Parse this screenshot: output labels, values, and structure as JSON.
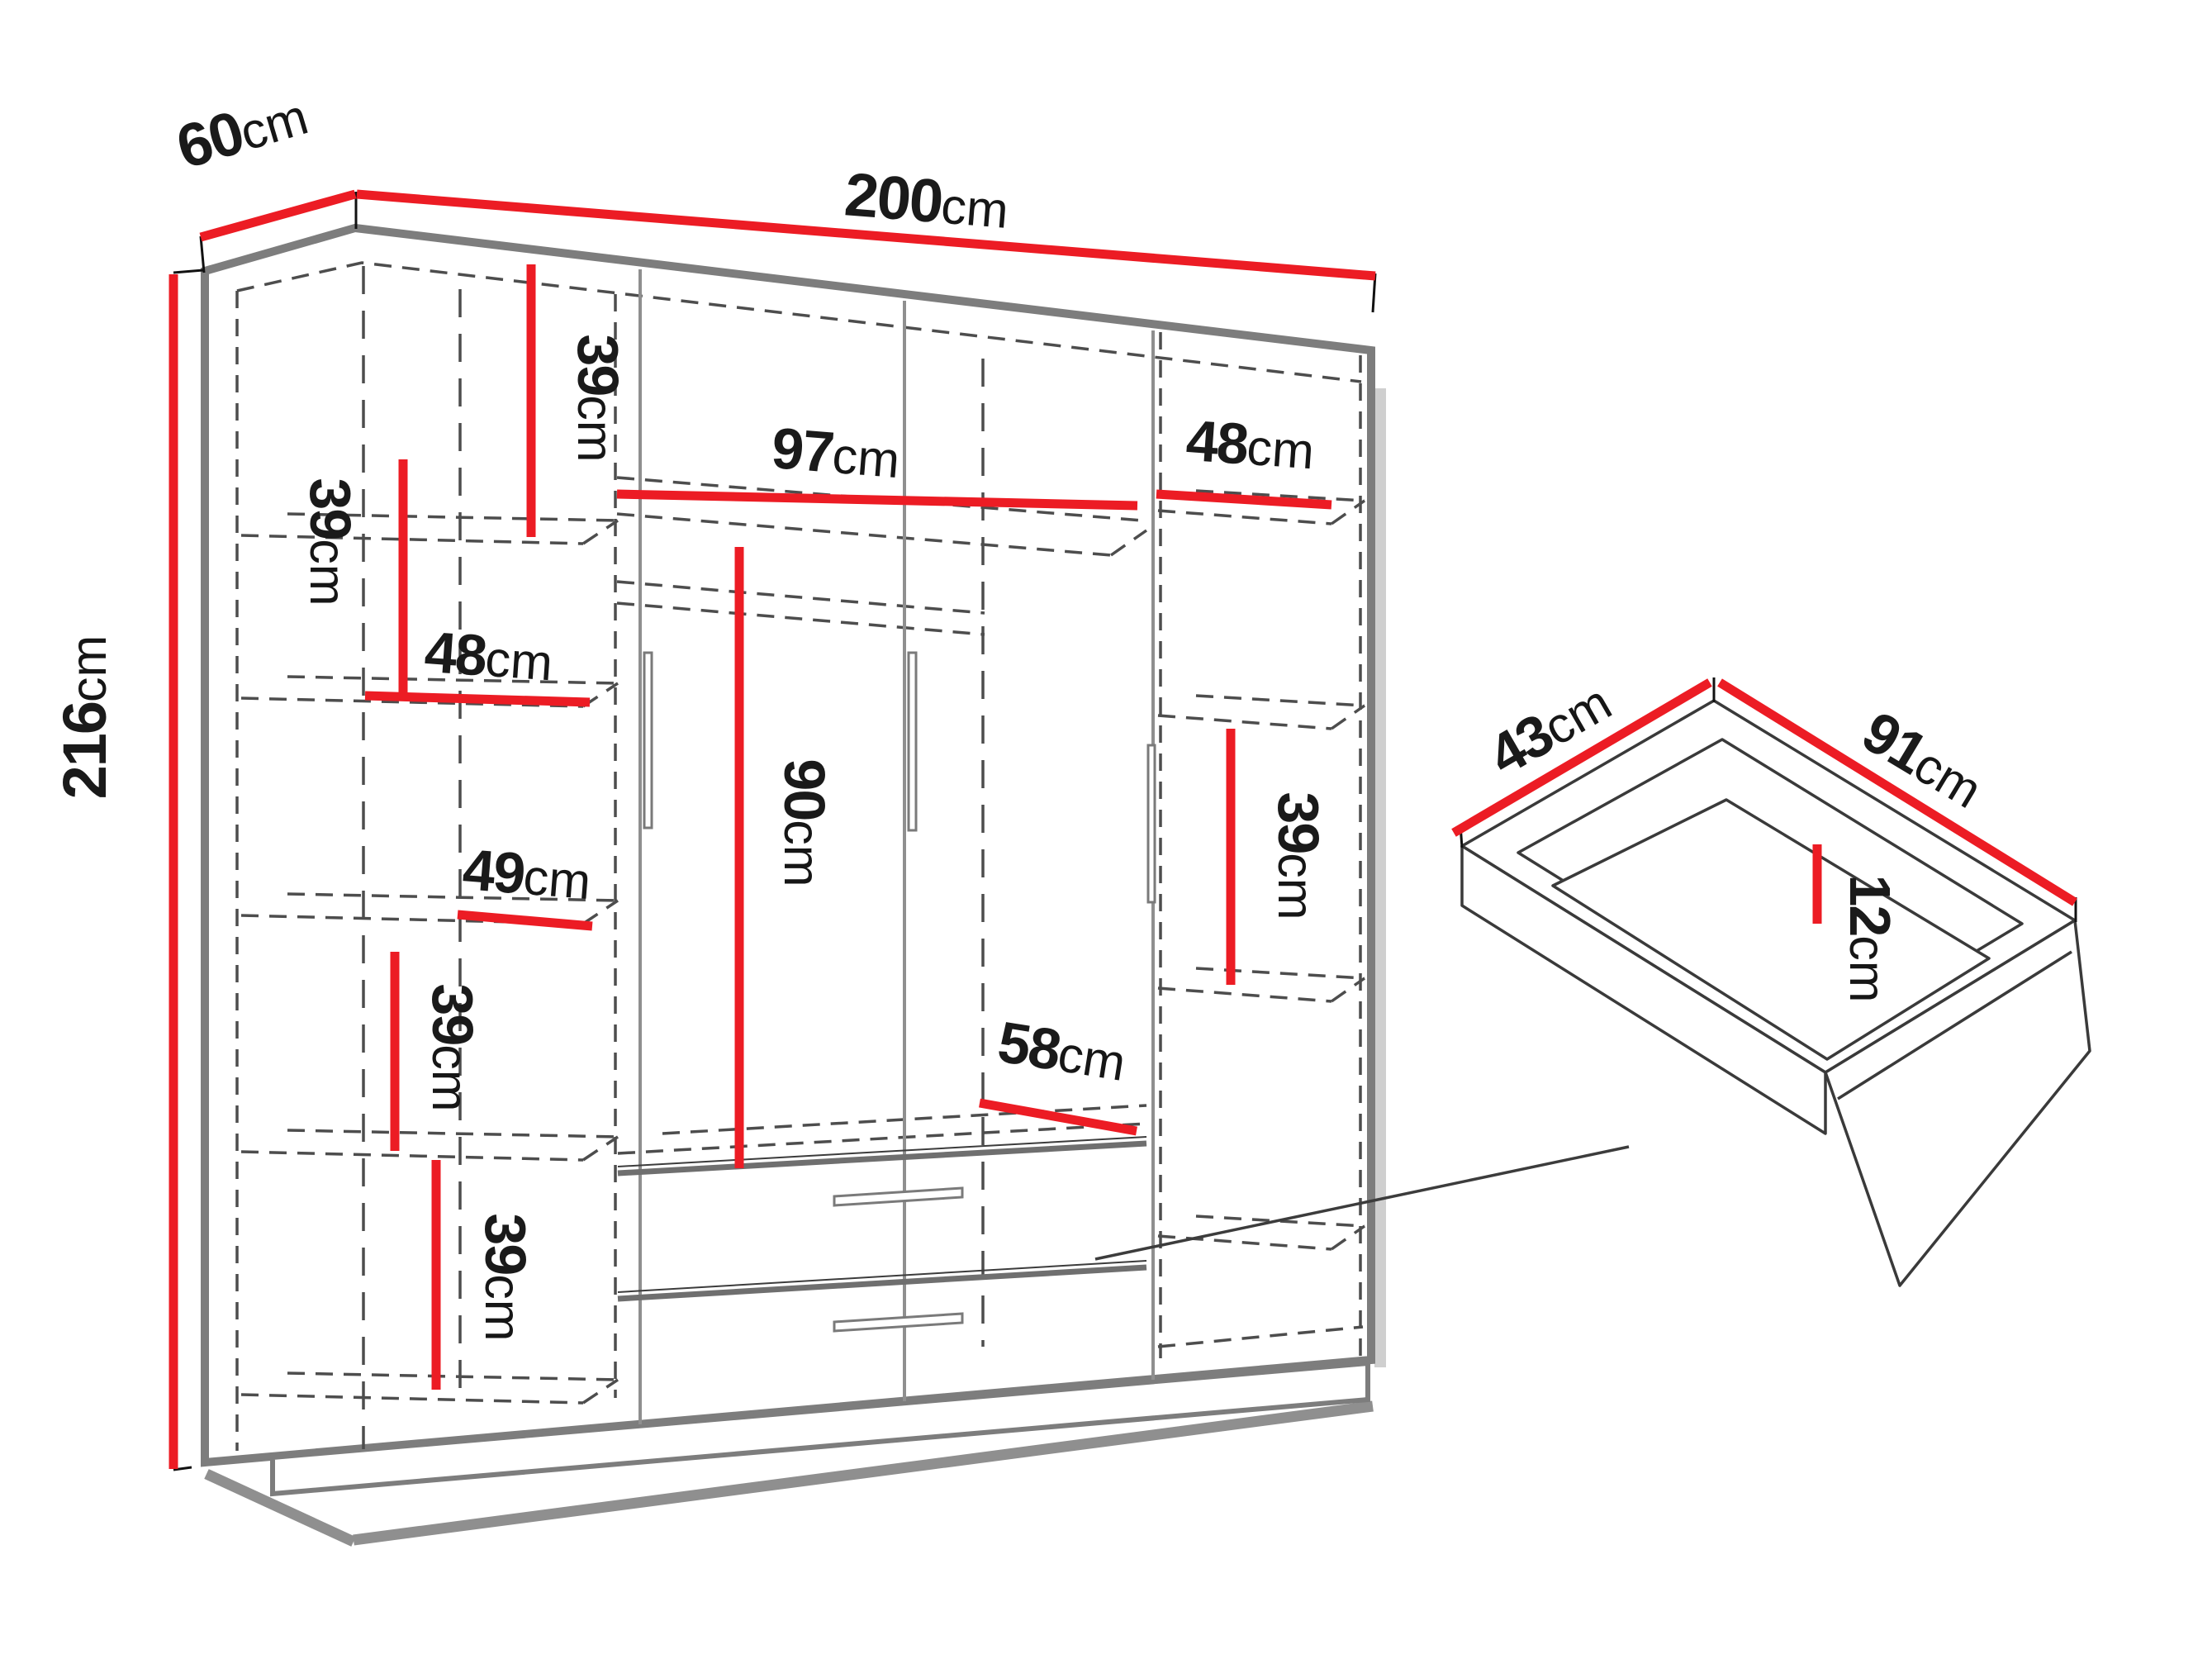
{
  "colors": {
    "dimension_red": "#ec1c24",
    "outline_gray": "#7d7d7d",
    "dash_gray": "#4d4d4d",
    "text_black": "#1a1a1a"
  },
  "wardrobe": {
    "width": {
      "value": "200",
      "unit": "cm"
    },
    "depth": {
      "value": "60",
      "unit": "cm"
    },
    "height": {
      "value": "216",
      "unit": "cm"
    },
    "interior": {
      "left_top_compartment": {
        "value": "39",
        "unit": "cm"
      },
      "left_upper_compartment": {
        "value": "39",
        "unit": "cm"
      },
      "left_shelf_width_upper": {
        "value": "48",
        "unit": "cm"
      },
      "left_shelf_width_lower": {
        "value": "49",
        "unit": "cm"
      },
      "left_lower_compartment": {
        "value": "39",
        "unit": "cm"
      },
      "left_bottom_compartment": {
        "value": "39",
        "unit": "cm"
      },
      "middle_top_width": {
        "value": "97",
        "unit": "cm"
      },
      "hanging_space_height": {
        "value": "90",
        "unit": "cm"
      },
      "drawer_opening_width": {
        "value": "58",
        "unit": "cm"
      },
      "right_shelf_width": {
        "value": "48",
        "unit": "cm"
      },
      "right_compartment_height": {
        "value": "39",
        "unit": "cm"
      }
    }
  },
  "drawer": {
    "depth": {
      "value": "43",
      "unit": "cm"
    },
    "width": {
      "value": "91",
      "unit": "cm"
    },
    "height": {
      "value": "12",
      "unit": "cm"
    }
  }
}
